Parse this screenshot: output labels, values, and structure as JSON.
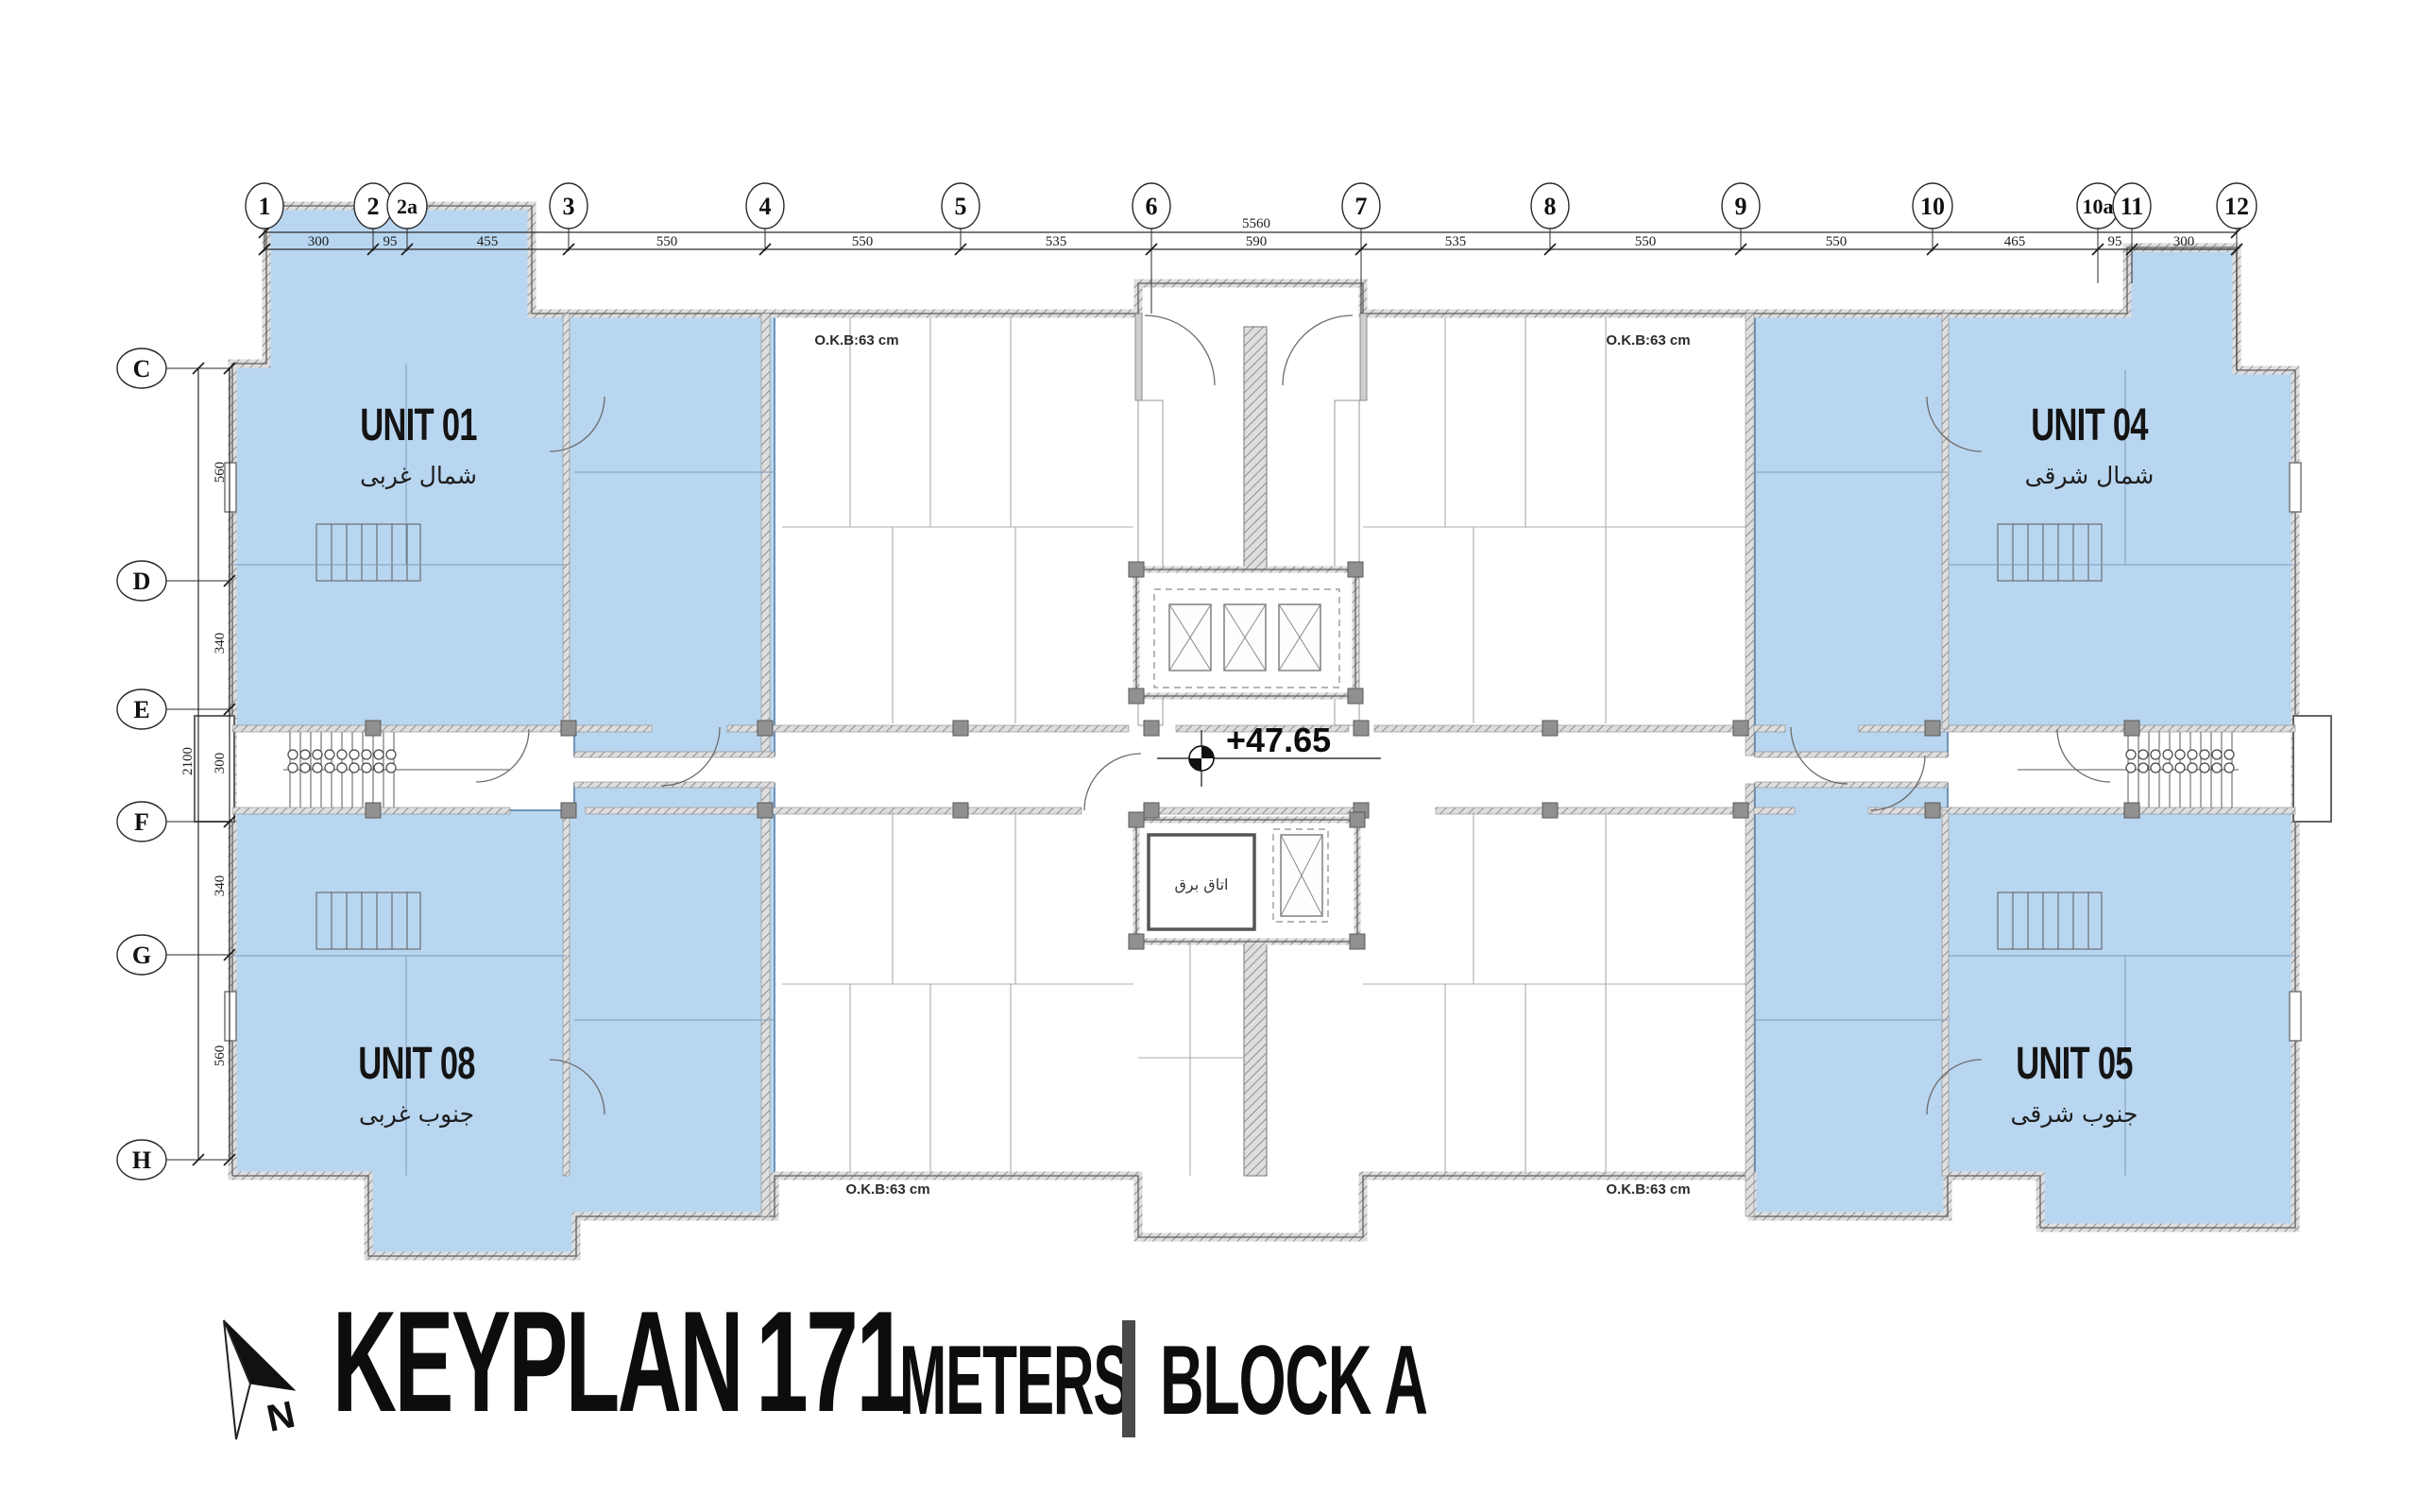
{
  "title": {
    "keyplan": "KEYPLAN",
    "height": "171",
    "meters": "METERS",
    "block": "BLOCK A",
    "north_letter": "N"
  },
  "units": [
    {
      "label": "UNIT 01",
      "subtitle": "شمال غربی"
    },
    {
      "label": "UNIT 04",
      "subtitle": "شمال شرقی"
    },
    {
      "label": "UNIT 08",
      "subtitle": "جنوب غربی"
    },
    {
      "label": "UNIT 05",
      "subtitle": "جنوب شرقی"
    }
  ],
  "grid": {
    "columns": [
      "1",
      "2",
      "2a",
      "3",
      "4",
      "5",
      "6",
      "7",
      "8",
      "9",
      "10",
      "10a",
      "11",
      "12"
    ],
    "rows": [
      "C",
      "D",
      "E",
      "F",
      "G",
      "H"
    ]
  },
  "dimensions": {
    "top_total": "5560",
    "top_segments": [
      "300",
      "95",
      "455",
      "550",
      "550",
      "535",
      "590",
      "535",
      "550",
      "550",
      "465",
      "95",
      "300"
    ],
    "left_total": "2100",
    "left_segments": [
      "560",
      "340",
      "300",
      "340",
      "560"
    ]
  },
  "annotations": {
    "level": "+47.65",
    "okb": "O.K.B:63 cm",
    "electrical_room": "اتاق برق"
  },
  "colors": {
    "unit_fill": "#b9d6f0",
    "unit_border": "#6f94b8",
    "wall": "#6a6a6a",
    "text": "#111111",
    "divider": "#4a4a4a"
  }
}
